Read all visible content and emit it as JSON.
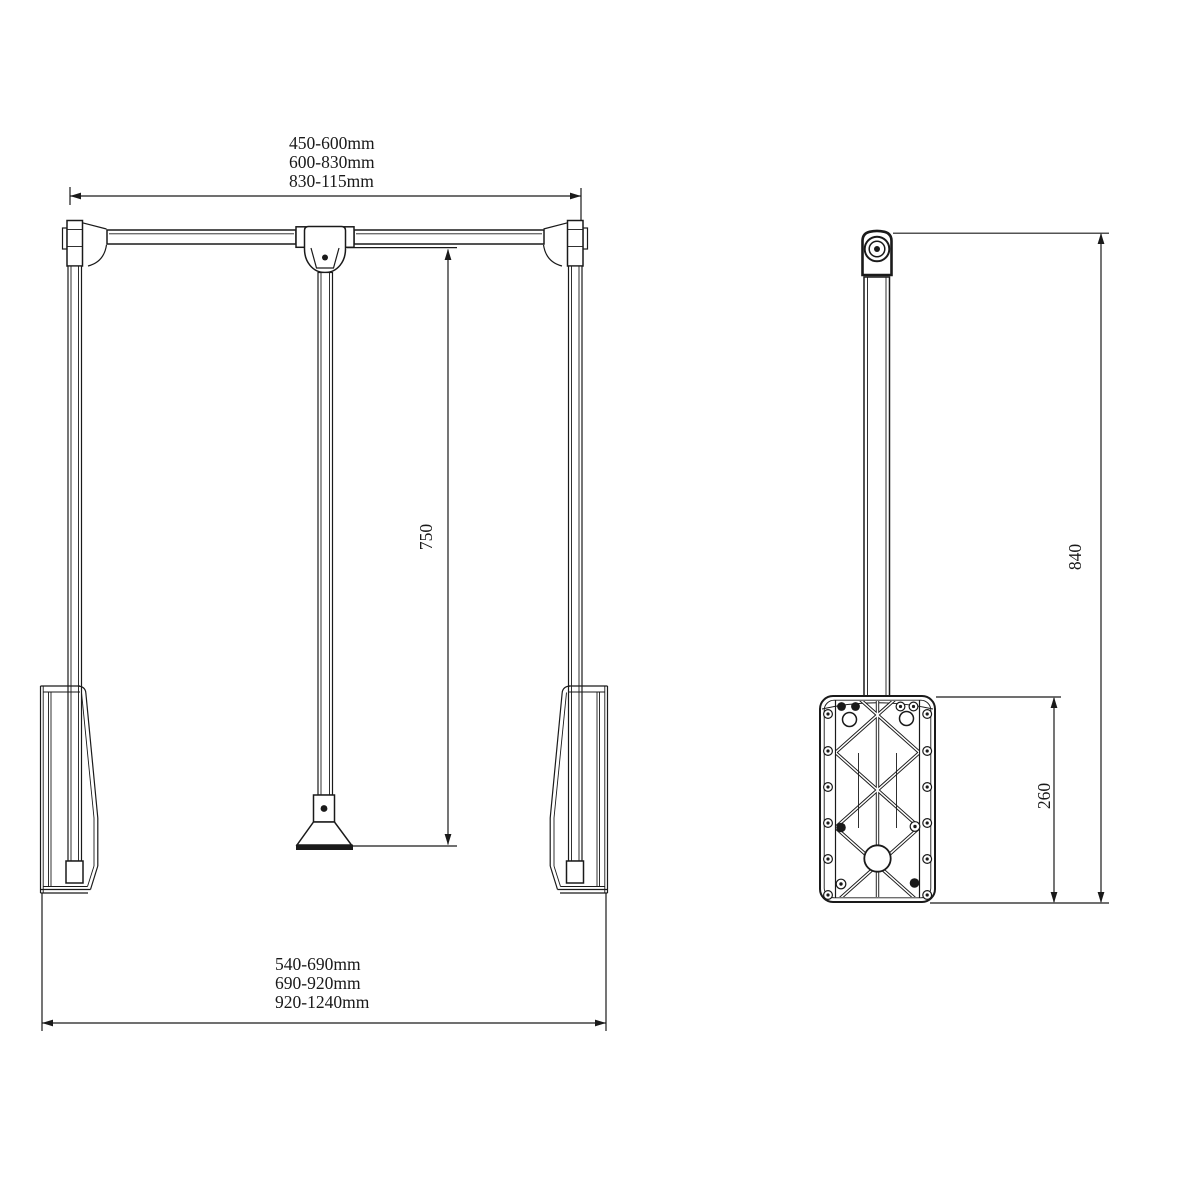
{
  "style": {
    "background": "#ffffff",
    "line_color": "#1a1a1a"
  },
  "front_view": {
    "rail_width_labels": [
      "450-600mm",
      "600-830mm",
      "830-115mm"
    ],
    "overall_width_labels": [
      "540-690mm",
      "690-920mm",
      "920-1240mm"
    ],
    "drop_dimension": "750"
  },
  "side_view": {
    "overall_height_dimension": "840",
    "plate_height_dimension": "260"
  }
}
